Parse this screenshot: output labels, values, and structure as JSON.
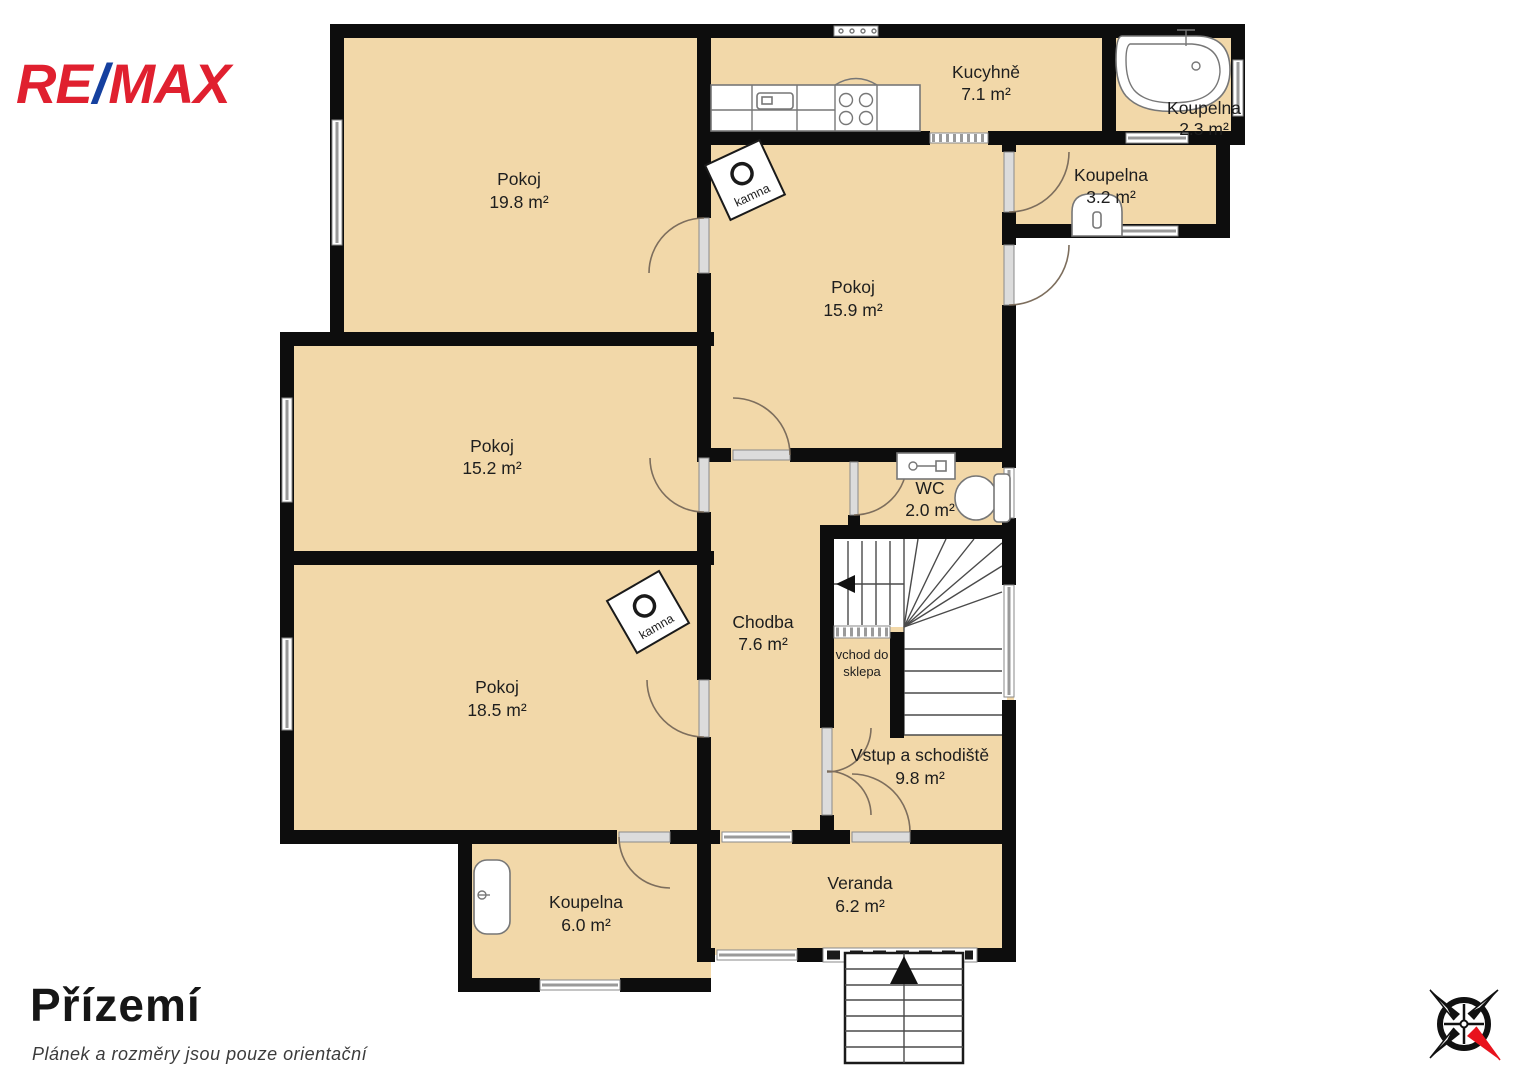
{
  "logo": {
    "re": "RE",
    "slash": "/",
    "max": "MAX"
  },
  "footer": {
    "title": "Přízemí",
    "disclaimer": "Plánek a rozměry jsou pouze orientační"
  },
  "rooms": [
    {
      "name": "Pokoj",
      "area": "19.8 m²"
    },
    {
      "name": "Kucyhně",
      "area": "7.1 m²"
    },
    {
      "name": "Koupelna",
      "area": "2.3 m²"
    },
    {
      "name": "Koupelna",
      "area": "3.2 m²"
    },
    {
      "name": "Pokoj",
      "area": "15.9 m²"
    },
    {
      "name": "Pokoj",
      "area": "15.2 m²"
    },
    {
      "name": "WC",
      "area": "2.0 m²"
    },
    {
      "name": "Chodba",
      "area": "7.6 m²"
    },
    {
      "name": "Pokoj",
      "area": "18.5 m²"
    },
    {
      "name": "Vstup a schodiště",
      "area": "9.8 m²"
    },
    {
      "name": "Koupelna",
      "area": "6.0 m²"
    },
    {
      "name": "Veranda",
      "area": "6.2 m²"
    }
  ],
  "annotations": {
    "basement_line1": "vchod do",
    "basement_line2": "sklepa",
    "stove": "kamna"
  },
  "colors": {
    "floor": "#f2d8a9",
    "wall": "#0d0d0d",
    "logo_red": "#e0202f",
    "logo_blue": "#15409f",
    "compass_red": "#e8131d"
  }
}
